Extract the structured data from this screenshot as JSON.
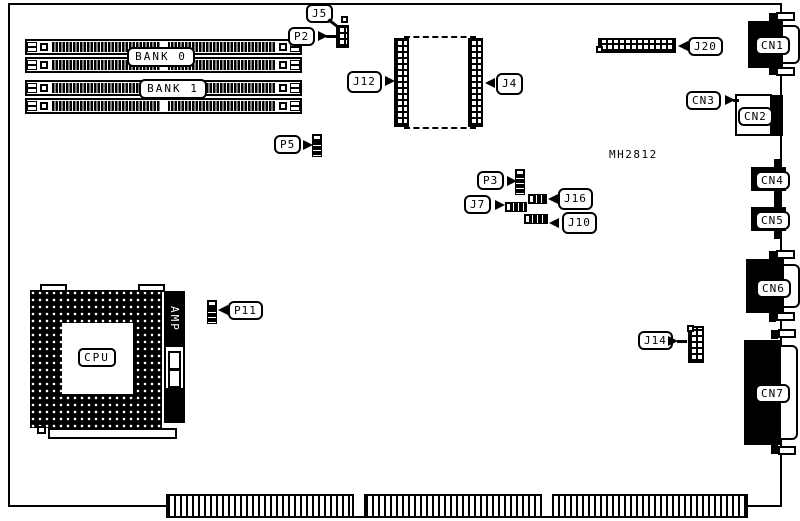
{
  "diagram": {
    "type": "motherboard-connector-location-diagram",
    "part_text": "MH2812",
    "colors": {
      "foreground": "#000000",
      "background": "#ffffff"
    },
    "memory_banks": [
      {
        "label": "BANK 0"
      },
      {
        "label": "BANK 1"
      }
    ],
    "cpu": {
      "socket_label": "CPU",
      "regulator_label": "AMP"
    },
    "labels": {
      "j5": "J5",
      "p2": "P2",
      "p5": "P5",
      "p3": "P3",
      "p11": "P11",
      "j4": "J4",
      "j7": "J7",
      "j10": "J10",
      "j12": "J12",
      "j14": "J14",
      "j16": "J16",
      "j20": "J20",
      "cn1": "CN1",
      "cn2": "CN2",
      "cn3": "CN3",
      "cn4": "CN4",
      "cn5": "CN5",
      "cn6": "CN6",
      "cn7": "CN7"
    }
  }
}
